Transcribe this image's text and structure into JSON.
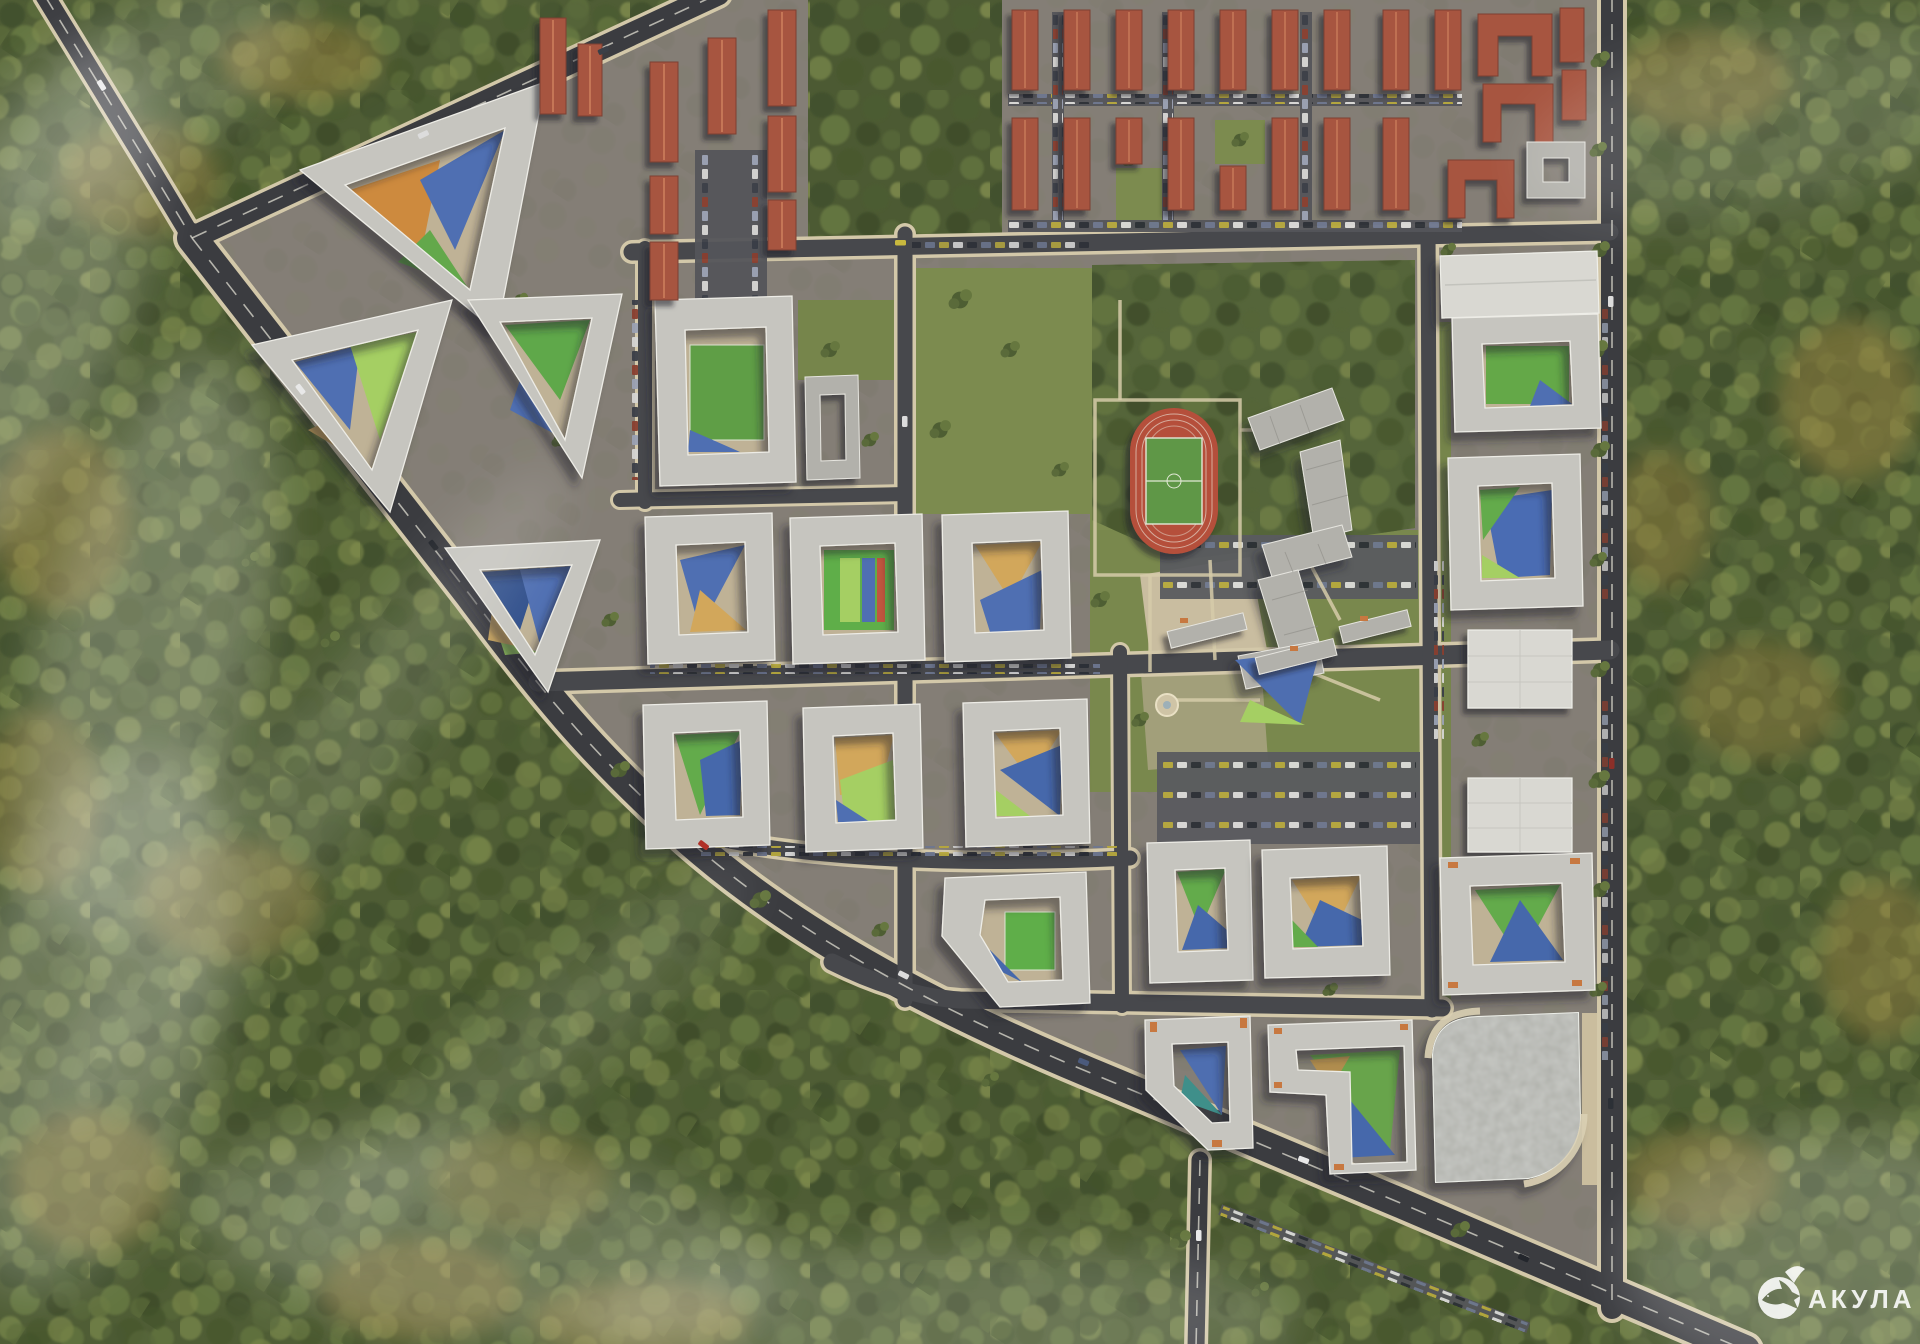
{
  "image": {
    "type": "aerial-masterplan-render",
    "description": "Bird's-eye 3D visualization of a residential district masterplan surrounded by autumn forest with haze"
  },
  "watermark": {
    "text": "АКУЛА",
    "logo": "shark-in-droplet"
  },
  "features": {
    "forest": "Dense mixed forest with autumn-colored patches surrounding the site",
    "residential_blocks": "Mid-rise perimeter apartment blocks (triangular and square) with colorful courtyard playgrounds",
    "townhouses": "Grid of terracotta-roofed townhouse rows with parking courts",
    "red_apartments": "Red-roofed low-rise apartment slabs and U-shaped brick buildings",
    "school_campus": "School with zigzag building, wooded grounds and plaza with fountain",
    "stadium": "Red running track with green football pitch",
    "parking_garage": "Large multi-storey parking structure with curved corner cuts",
    "retail": "White flat-roofed commercial buildings",
    "roads": "Perimeter boulevard and internal street grid with parallel parking"
  },
  "palette": {
    "forest_base": "#4f5d35",
    "forest_autumn": "#97823f",
    "ground": "#847e76",
    "lawn": "#7c8b4f",
    "road_asphalt": "#3b3c40",
    "sidewalk": "#d3c8a9",
    "roof_light": "#c6c5bf",
    "roof_red": "#a7553f",
    "court_tan": "#cda75e",
    "court_blue": "#4f6fb2",
    "court_navy": "#31508c",
    "court_green": "#5fa84a",
    "court_lightgreen": "#a5cf63",
    "track_red": "#b5503b",
    "field_green": "#5e9747",
    "accent_orange": "#c77840",
    "watermark_white": "#ffffff"
  }
}
